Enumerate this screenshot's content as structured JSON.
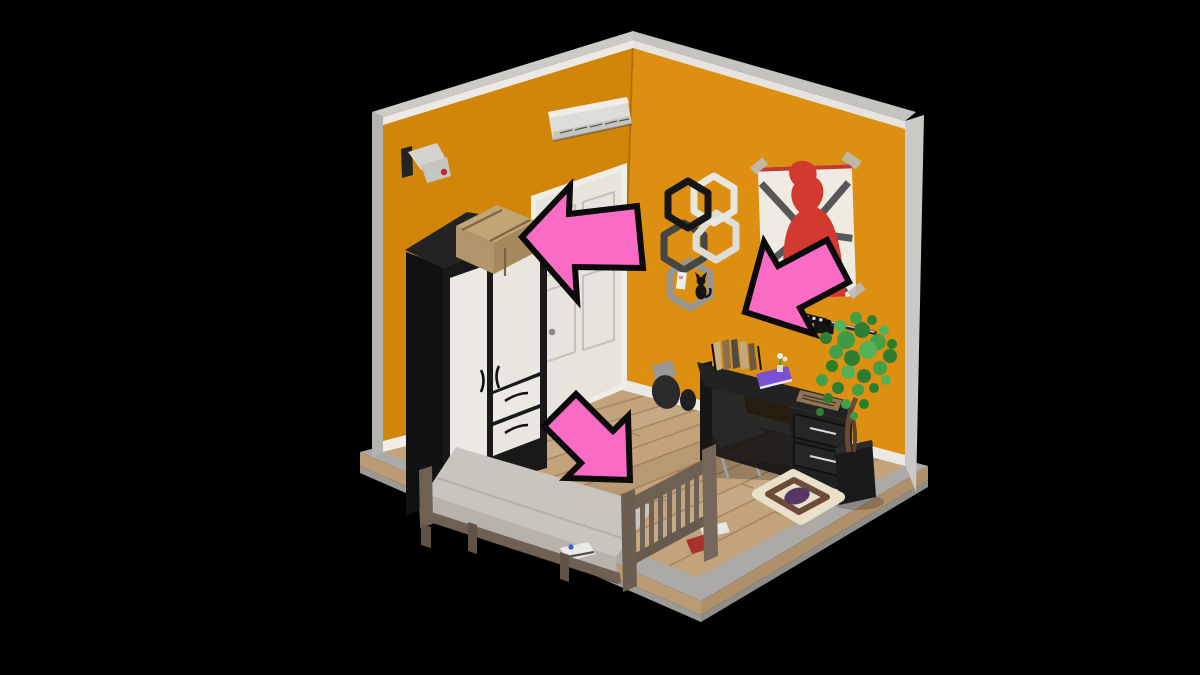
{
  "scene": {
    "type": "isometric-3d-room-screenshot",
    "room": "bedroom",
    "objects": [
      "security-camera",
      "air-conditioner-unit",
      "white-door",
      "black-white-wardrobe",
      "cardboard-box-on-wardrobe",
      "hexagon-wall-shelf",
      "cat-figurine",
      "red-silhouette-poster",
      "wall-mounted-katana",
      "black-desk",
      "desk-book-organizer",
      "purple-notebook",
      "keyboard",
      "white-office-chair",
      "backpack-on-floor",
      "potted-plant",
      "round-rug",
      "wooden-bed",
      "sneaker-under-bed",
      "red-cloth-under-bed",
      "paper-under-bed"
    ]
  },
  "annotations": {
    "arrows": [
      {
        "id": "arrow-left",
        "direction": "left",
        "target": "cardboard-box-on-wardrobe"
      },
      {
        "id": "arrow-down-left",
        "direction": "down-left",
        "target": "black-desk"
      },
      {
        "id": "arrow-down-right",
        "direction": "down-right",
        "target": "wooden-bed"
      }
    ]
  },
  "colors": {
    "background": "#000000",
    "wall_left": "#D18609",
    "wall_right": "#DC8F10",
    "trim_top": "#CDCBC7",
    "trim_left": "#B5B3AE",
    "trim_right": "#CBC9C5",
    "crown": "#ECEAE4",
    "baseboard": "#EFEDE7",
    "floor": "#C2A37C",
    "slab_face": "#ACAAA6",
    "slab_side": "#BA9B74",
    "slab_rim": "#9B9995",
    "wardrobe_body": "#191919",
    "wardrobe_door": "#ECE9E2",
    "box_top": "#C1A676",
    "box_front": "#A5885C",
    "door": "#E7E4DD",
    "door_frame": "#F0EDE7",
    "ac_unit": "#DEDCD7",
    "poster_bg": "#EFEBE2",
    "poster_red": "#D23A30",
    "poster_ray": "#575757",
    "desk": "#222222",
    "chair": "#E9E7E1",
    "plant_green": "#3F9A43",
    "plant_pot": "#1A1A1A",
    "rug_base": "#E9E0CA",
    "rug_ring": "#6E4B38",
    "rug_center": "#573564",
    "bed_frame": "#6E6154",
    "mattress": "#C9C5BE",
    "arrow_fill": "#FA6BC6",
    "arrow_outline": "#0A0A0A"
  }
}
